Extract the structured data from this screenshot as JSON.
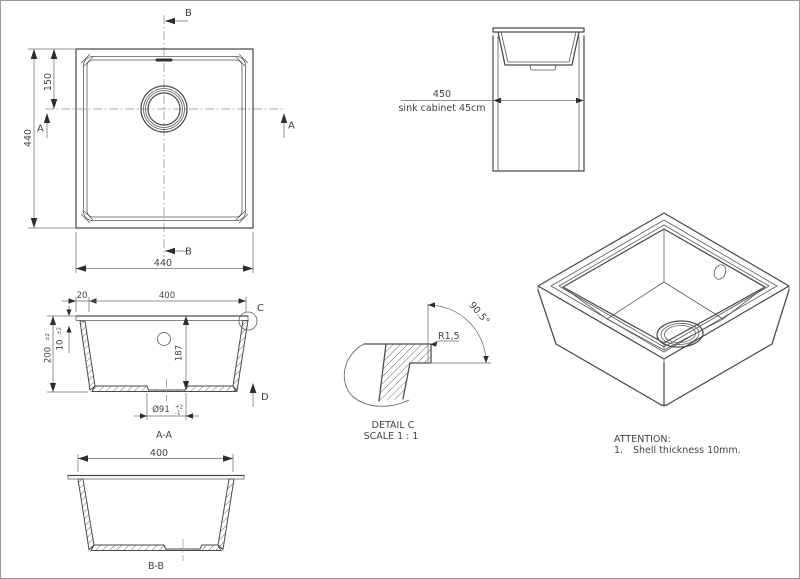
{
  "colors": {
    "background": "#ffffff",
    "line": "#4a4a4a",
    "dimension_line": "#6b6b6b",
    "text": "#3e434b"
  },
  "top_view": {
    "dim_left": "440",
    "dim_bottom": "440",
    "dim_drain_offset": "150",
    "marker_b_top": "B",
    "marker_b_bottom": "B",
    "marker_a_left": "A",
    "marker_a_right": "A"
  },
  "cabinet_view": {
    "dim": "450",
    "caption": "sink cabinet 45cm"
  },
  "section_aa": {
    "dim_rim": "20",
    "dim_opening": "400",
    "dim_depth": "200",
    "dim_depth_tol": "±2",
    "dim_shell": "10",
    "dim_shell_tol": "±2",
    "dim_inner_depth": "187",
    "dim_drain": "Ø91",
    "dim_drain_tol_plus": "+2",
    "dim_drain_tol_minus": "-1",
    "marker_detail": "C",
    "marker_direction": "D",
    "label": "A-A"
  },
  "section_bb": {
    "dim_width": "400",
    "label": "B-B"
  },
  "detail_c": {
    "radius": "R1,5",
    "angle": "90.5°",
    "title": "DETAIL C",
    "scale": "SCALE 1 : 1"
  },
  "attention": {
    "title": "ATTENTION:",
    "item_no": "1.",
    "item_text": "Shell thickness 10mm."
  }
}
